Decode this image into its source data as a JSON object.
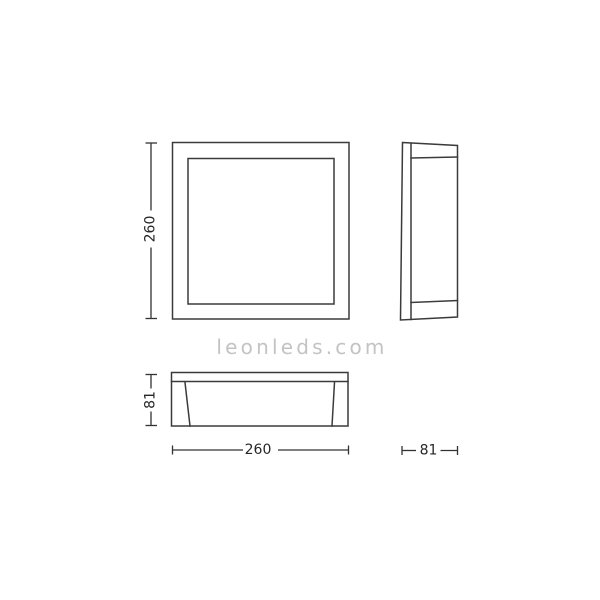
{
  "dims": {
    "front_height": "260",
    "bottom_width": "260",
    "bottom_depth": "81",
    "side_depth": "81"
  },
  "watermark": {
    "text": "leonleds.com"
  },
  "colors": {
    "line": "#3b3b3b",
    "dim_line": "#333333",
    "dim_text": "#262626",
    "watermark": "#c3c3c3",
    "background": "#ffffff"
  }
}
